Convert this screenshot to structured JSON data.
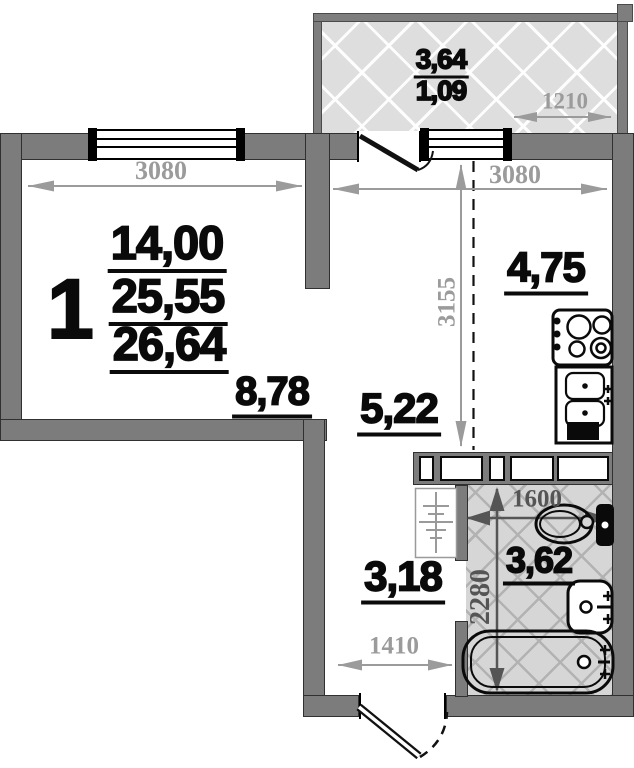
{
  "unit": {
    "number": "1"
  },
  "living_room": {
    "area_main": "14,00",
    "area_mid": "25,55",
    "area_total": "26,64",
    "area_secondary": "8,78",
    "dim_width": "3080"
  },
  "kitchen": {
    "area": "4,75",
    "dim_width": "3080",
    "dim_depth": "3155"
  },
  "hall": {
    "area": "5,22"
  },
  "entry": {
    "area": "3,18",
    "dim_width": "1410"
  },
  "bathroom": {
    "area": "3,62",
    "dim_width": "1600",
    "dim_depth": "2280"
  },
  "balcony": {
    "area_total": "3,64",
    "area_counted": "1,09",
    "dim_width": "1210"
  },
  "colors": {
    "wall": "#7c7c7c",
    "dim_light": "#9b9b9b",
    "dim_dark": "#555555",
    "bath_floor": "#d6d6d6",
    "balcony_floor": "#dedede"
  }
}
